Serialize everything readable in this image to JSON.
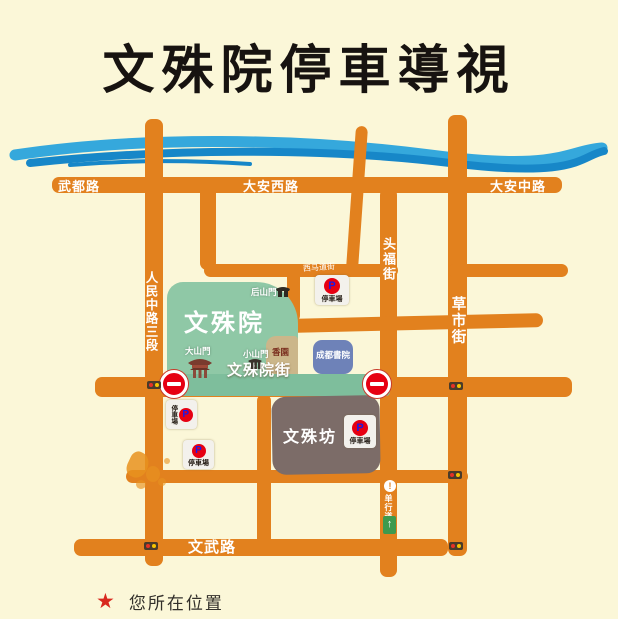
{
  "title": "文殊院停車導視",
  "roads": {
    "wudulu": "武都路",
    "daanxilu": "大安西路",
    "daanzhonglu": "大安中路",
    "renminzhonglu_sanduan": "人民中路三段",
    "ximadaojie": "西马道街",
    "toufujie": "头福街",
    "caoshijie": "草市街",
    "wenshuyuanjie": "文殊院街",
    "wenwulu": "文武路"
  },
  "places": {
    "wenshuyuan": "文殊院",
    "wenshufang": "文殊坊",
    "chengdushuyuan": "成都書院",
    "houshanmen": "后山門",
    "dashanmen": "大山門",
    "xiaoshanmen": "小山門",
    "xiangyuan": "香園"
  },
  "signs": {
    "parking": "停車場",
    "parking_letter": "P",
    "one_way": "单行道",
    "exclaim": "!",
    "arrow_up": "↑"
  },
  "legend": {
    "star_label": "您所在位置"
  },
  "colors": {
    "background": "#FBF7D8",
    "road_orange": "#E2811E",
    "river_light": "#35A8DC",
    "river_dark": "#1787C8",
    "temple_green": "#8FC8A6",
    "street_band_green": "#7EBE9C",
    "wenshufang_gray": "#7C6C68",
    "shuyuan_blue": "#6E82B8",
    "sign_red": "#E60012",
    "parking_p_blue": "#1A1AE6",
    "star_red": "#D8281E"
  }
}
